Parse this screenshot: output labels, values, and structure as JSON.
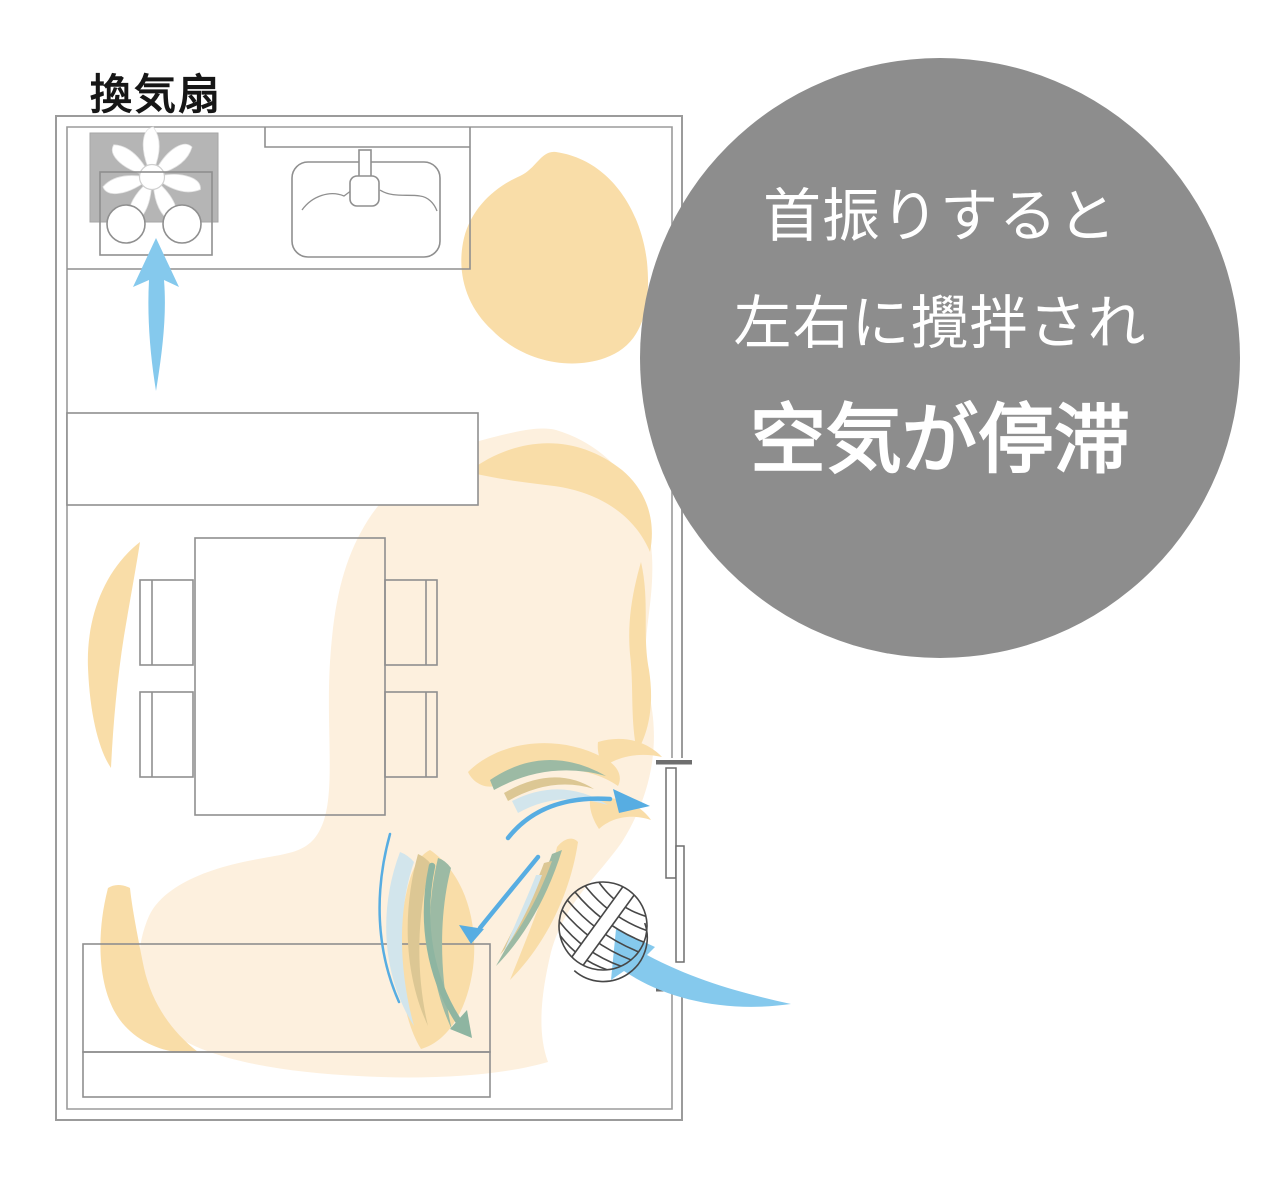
{
  "labels": {
    "ventilation_fan": "換気扇"
  },
  "callout": {
    "line1": "首振りすると",
    "line2": "左右に攪拌され",
    "line3": "空気が停滞",
    "bg_color": "#8d8d8d",
    "text_color": "#ffffff"
  },
  "colors": {
    "blob_light": "#fdf0de",
    "blob_dark": "#f9dda8",
    "swoosh_tan": "#dcc794",
    "swoosh_sage": "#9cbaa4",
    "swoosh_pale_blue": "#d2e5ec",
    "arrow_blue": "#85c9ed",
    "arrow_blue_line": "#57ade2",
    "arrow_sage": "#8eb5a1",
    "fan_box_gray": "#b5b5b5",
    "wall_stroke": "#9b9b9b",
    "furniture_stroke": "#8f8f8f",
    "door_stroke": "#6e6e6e",
    "ball_stroke": "#474747"
  },
  "icons": {
    "ventilation_fan": "fan-blades-icon",
    "circulator": "ball-fan-icon",
    "airflow": "curved-arrow-icon"
  },
  "diagram": {
    "elements": [
      "kitchen-ventilation-fan",
      "stove",
      "sink",
      "kitchen-counter",
      "cabinet",
      "dining-table",
      "chairs",
      "sofa",
      "sliding-door",
      "circulator-fan",
      "stagnant-air-areas",
      "airflow-arrows"
    ]
  }
}
